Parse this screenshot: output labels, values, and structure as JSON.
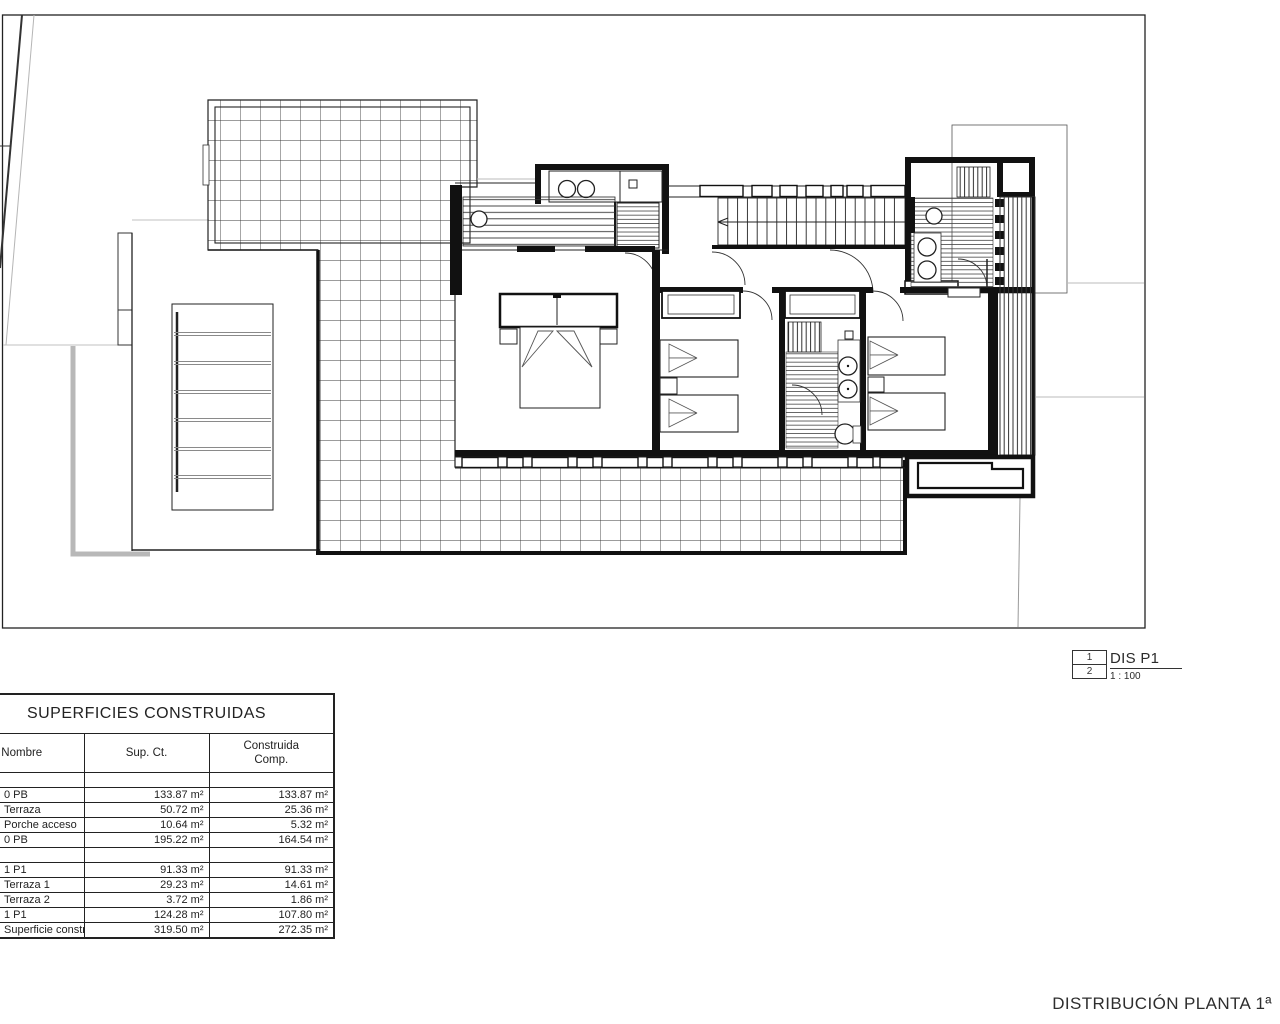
{
  "table": {
    "title": "SUPERFICIES CONSTRUIDAS",
    "columns": [
      "Nombre",
      "Sup. Ct.",
      "Construida\nComp."
    ],
    "rows": [
      [
        "",
        "",
        ""
      ],
      [
        "0 PB",
        "133.87 m²",
        "133.87 m²"
      ],
      [
        "Terraza",
        "50.72 m²",
        "25.36 m²"
      ],
      [
        "Porche acceso",
        "10.64 m²",
        "5.32 m²"
      ],
      [
        "0 PB",
        "195.22 m²",
        "164.54 m²"
      ],
      [
        "",
        "",
        ""
      ],
      [
        "1 P1",
        "91.33 m²",
        "91.33 m²"
      ],
      [
        "Terraza 1",
        "29.23 m²",
        "14.61 m²"
      ],
      [
        "Terraza 2",
        "3.72 m²",
        "1.86 m²"
      ],
      [
        "1 P1",
        "124.28 m²",
        "107.80 m²"
      ],
      [
        "Superficie construida total",
        "319.50 m²",
        "272.35 m²"
      ]
    ]
  },
  "legend": {
    "ref_top": "1",
    "ref_bottom": "2",
    "code": "DIS P1",
    "scale": "1 : 100"
  },
  "drawing_title": "DISTRIBUCIÓN PLANTA 1ª",
  "colors": {
    "line": "#1a1a1a",
    "light_gray": "#b5b5b5",
    "background": "#ffffff"
  }
}
